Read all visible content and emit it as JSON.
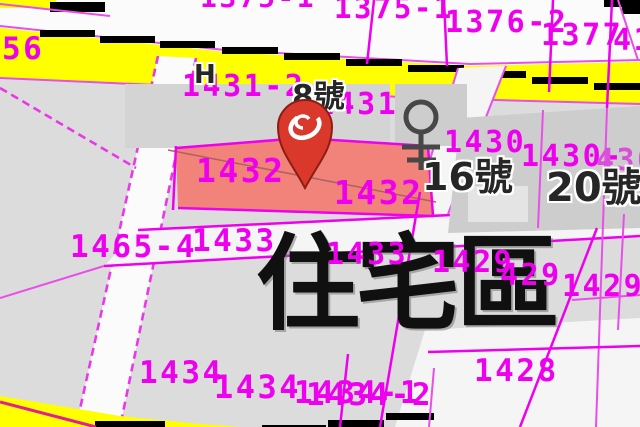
{
  "colors": {
    "magenta": "#ee00ee",
    "yellow": "#ffff00",
    "parcel_highlight": "#f1837b",
    "pin_red": "#d9382a",
    "road_edge_black": "#000000"
  },
  "zone_label": {
    "text": "住宅區",
    "x": 256,
    "y": 232,
    "size": 104
  },
  "parcel_labels": [
    {
      "text": "1375-1",
      "x": 200,
      "y": -16,
      "size": 28
    },
    {
      "text": "1375-1",
      "x": 334,
      "y": -6,
      "size": 29
    },
    {
      "text": "1376-2",
      "x": 445,
      "y": 8,
      "size": 30
    },
    {
      "text": "1377",
      "x": 541,
      "y": 21,
      "size": 30
    },
    {
      "text": "41",
      "x": 613,
      "y": 26,
      "size": 30
    },
    {
      "text": "56",
      "x": 2,
      "y": 34,
      "size": 31
    },
    {
      "text": "1431-2",
      "x": 182,
      "y": 72,
      "size": 30
    },
    {
      "text": "1431",
      "x": 316,
      "y": 90,
      "size": 30
    },
    {
      "text": "1430",
      "x": 444,
      "y": 128,
      "size": 30
    },
    {
      "text": "1430-",
      "x": 521,
      "y": 142,
      "size": 30
    },
    {
      "text": "430",
      "x": 596,
      "y": 146,
      "size": 30,
      "color": "#d84fd8"
    },
    {
      "text": "1432",
      "x": 196,
      "y": 154,
      "size": 33
    },
    {
      "text": "1432",
      "x": 334,
      "y": 176,
      "size": 33
    },
    {
      "text": "1465-4",
      "x": 70,
      "y": 232,
      "size": 31
    },
    {
      "text": "1433",
      "x": 192,
      "y": 226,
      "size": 31
    },
    {
      "text": "1433",
      "x": 326,
      "y": 240,
      "size": 30
    },
    {
      "text": "1429",
      "x": 432,
      "y": 248,
      "size": 30
    },
    {
      "text": "429",
      "x": 500,
      "y": 261,
      "size": 30
    },
    {
      "text": "1429",
      "x": 562,
      "y": 272,
      "size": 30
    },
    {
      "text": "1428",
      "x": 474,
      "y": 356,
      "size": 31
    },
    {
      "text": "1434",
      "x": 139,
      "y": 358,
      "size": 31
    },
    {
      "text": "1434",
      "x": 214,
      "y": 371,
      "size": 32
    },
    {
      "text": "1434-1",
      "x": 294,
      "y": 378,
      "size": 31
    },
    {
      "text": "1434-2",
      "x": 306,
      "y": 380,
      "size": 31
    }
  ],
  "house_labels": [
    {
      "text": "8號",
      "x": 292,
      "y": 82,
      "size": 31
    },
    {
      "text": "16號",
      "x": 422,
      "y": 158,
      "size": 38
    },
    {
      "text": "20號",
      "x": 546,
      "y": 168,
      "size": 40
    },
    {
      "text": "H",
      "x": 194,
      "y": 62,
      "size": 26
    }
  ],
  "icons": {
    "pin": "location-pin",
    "building_symbol": "well-symbol",
    "pin_tip_marker": "cross-marker"
  }
}
